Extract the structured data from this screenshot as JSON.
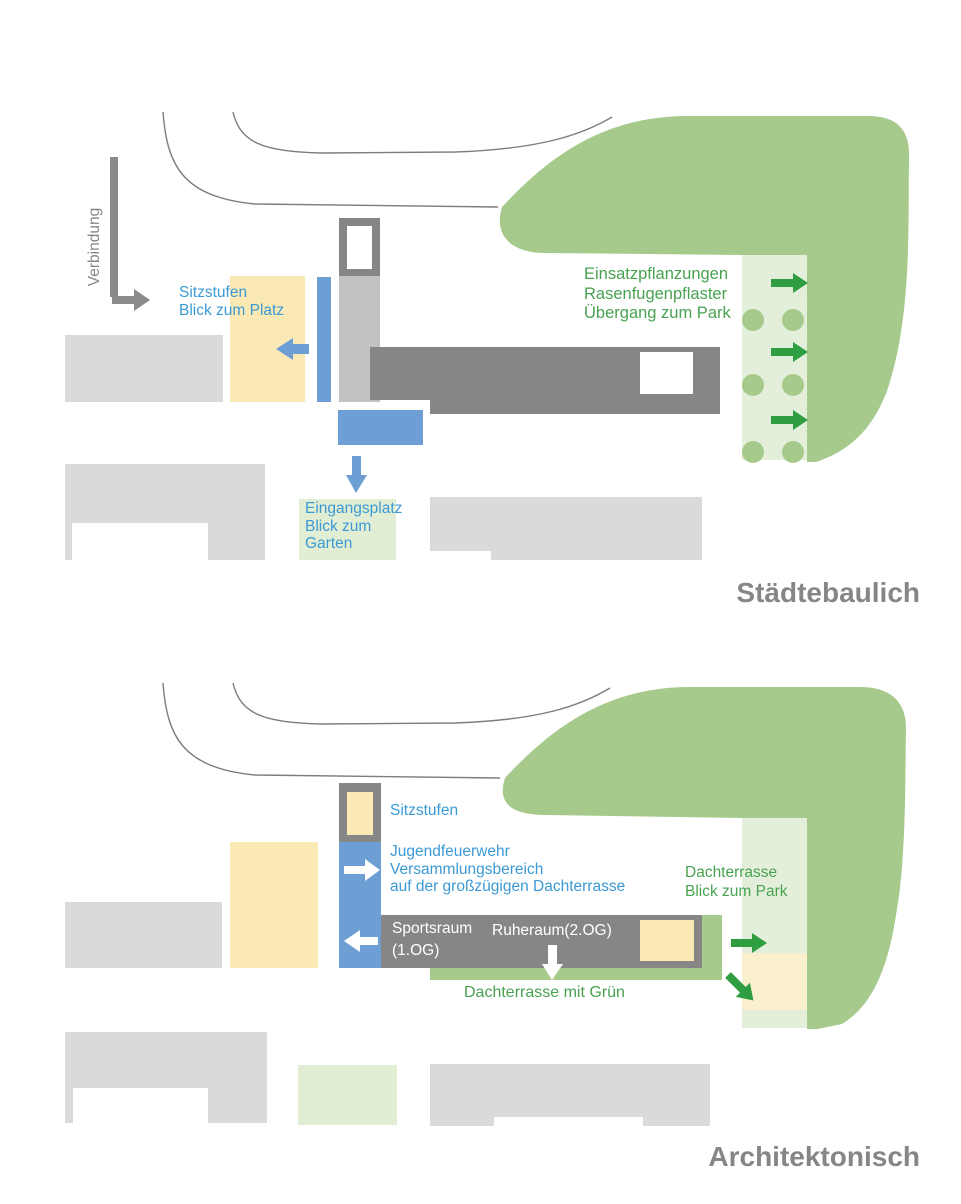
{
  "colors": {
    "park_green": "#a6ca8b",
    "pale_green_strip": "#e4efdb",
    "pale_green_box": "#e2eed3",
    "arrow_green": "#2f9e41",
    "text_green": "#48a251",
    "shape_blue": "#6d9fd4",
    "text_blue": "#3b99d4",
    "yellow": "#fae9b5",
    "pale_yellow": "#fbf0cd",
    "light_gray": "#d8dadb",
    "mid_gray": "#c2c2c2",
    "dark_gray": "#868686",
    "arrow_gray": "#8a8a8a",
    "title_gray": "#868686",
    "outline_gray": "#7d7d7d"
  },
  "diagram_top": {
    "title": "Städtebaulich",
    "verbindung": "Verbindung",
    "sitzstufen": [
      "Sitzstufen",
      "Blick zum Platz"
    ],
    "planting": [
      "Einsatzpflanzungen",
      "Rasenfugenpflaster",
      "Übergang zum Park"
    ],
    "eingangsplatz": [
      "Eingangsplatz",
      "Blick zum",
      "Garten"
    ]
  },
  "diagram_bottom": {
    "title": "Architektonisch",
    "sitzstufen": "Sitzstufen",
    "jugendfeuerwehr": [
      "Jugendfeuerwehr",
      "Versammlungsbereich",
      "auf der großzügigen Dachterrasse"
    ],
    "sportsraum": [
      "Sportsraum",
      "(1.OG)"
    ],
    "ruheraum": "Ruheraum(2.OG)",
    "dachterrasse_gruen": "Dachterrasse mit Grün",
    "dachterrasse_park": [
      "Dachterrasse",
      "Blick zum Park"
    ]
  }
}
